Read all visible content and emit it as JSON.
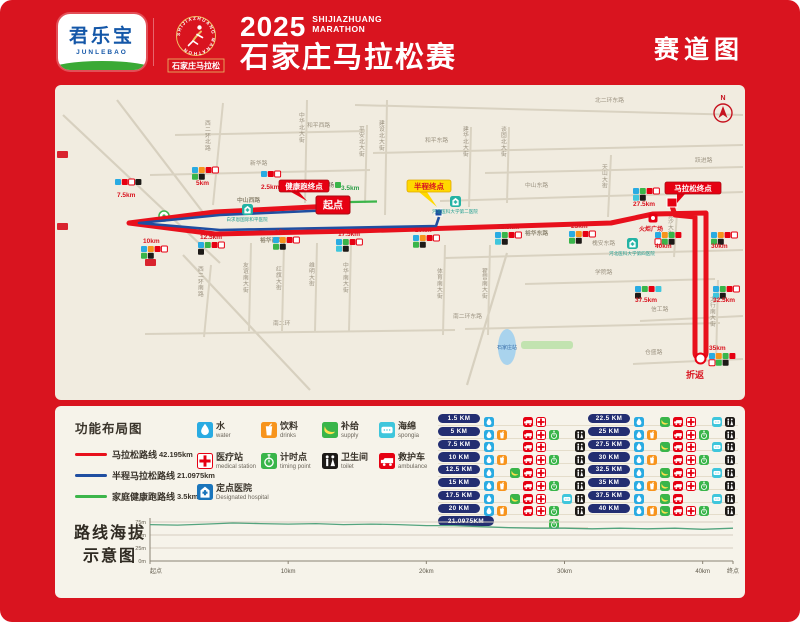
{
  "page": {
    "bg": "#d9141f",
    "map_bg": "#f1ece0",
    "panel_bg": "#f6f3ea"
  },
  "header": {
    "sponsor": {
      "cn": "君乐宝",
      "en": "JUNLEBAO"
    },
    "emblem": {
      "arc": "SHIJIAZHUANG MARATHON",
      "cn": "石家庄马拉松"
    },
    "title": {
      "year": "2025",
      "en_line1": "SHIJIAZHUANG",
      "en_line2": "MARATHON",
      "cn": "石家庄马拉松赛"
    },
    "page_label": "赛道图"
  },
  "map": {
    "north": "N",
    "diagonals": [
      [
        8,
        30,
        165,
        178
      ],
      [
        62,
        15,
        150,
        130
      ],
      [
        128,
        170,
        255,
        305
      ],
      [
        452,
        168,
        412,
        300
      ]
    ],
    "streets": [
      [
        300,
        20,
        688,
        30,
        "北二环东路",
        540,
        17,
        0
      ],
      [
        120,
        50,
        310,
        46,
        "和平西路",
        252,
        42,
        0
      ],
      [
        318,
        68,
        688,
        60,
        "和平东路",
        370,
        57,
        0
      ],
      [
        95,
        90,
        315,
        85,
        "新华路",
        195,
        80,
        0
      ],
      [
        430,
        88,
        688,
        82,
        "跃进路",
        640,
        77,
        0
      ],
      [
        385,
        116,
        688,
        107,
        "中山东路",
        470,
        102,
        0
      ],
      [
        390,
        173,
        688,
        165,
        "槐安东路",
        537,
        160,
        0
      ],
      [
        470,
        199,
        660,
        194,
        "学院路",
        540,
        189,
        0
      ],
      [
        90,
        249,
        400,
        245,
        "南二环",
        218,
        240,
        0
      ],
      [
        410,
        244,
        665,
        238,
        "南二环东路",
        398,
        233,
        0
      ],
      [
        585,
        236,
        688,
        231,
        "信工路",
        596,
        226,
        0
      ],
      [
        578,
        279,
        688,
        274,
        "仓盛路",
        590,
        269,
        0
      ],
      [
        168,
        18,
        158,
        120,
        "西二环北路",
        150,
        40,
        1
      ],
      [
        156,
        180,
        149,
        252,
        "西二环南路",
        143,
        186,
        1
      ],
      [
        252,
        15,
        250,
        118,
        "中华北大街",
        244,
        32,
        1
      ],
      [
        312,
        40,
        310,
        118,
        "平安北大街",
        304,
        46,
        1
      ],
      [
        332,
        15,
        330,
        130,
        "建设北大街",
        324,
        40,
        1
      ],
      [
        416,
        42,
        414,
        122,
        "建华北大街",
        408,
        46,
        1
      ],
      [
        454,
        42,
        452,
        118,
        "谈固北大街",
        446,
        46,
        1
      ],
      [
        196,
        158,
        194,
        246,
        "友谊南大街",
        188,
        182,
        1
      ],
      [
        229,
        158,
        227,
        246,
        "红旗大街",
        221,
        186,
        1
      ],
      [
        262,
        158,
        260,
        246,
        "维明大街",
        254,
        182,
        1
      ],
      [
        296,
        158,
        294,
        246,
        "中华南大街",
        288,
        182,
        1
      ],
      [
        390,
        160,
        388,
        250,
        "体育南大街",
        382,
        188,
        1
      ],
      [
        435,
        160,
        433,
        250,
        "翟营南大街",
        427,
        188,
        1
      ],
      [
        556,
        70,
        553,
        132,
        "天山大街",
        547,
        84,
        1
      ],
      [
        622,
        128,
        619,
        172,
        "金沙大街",
        613,
        132,
        1
      ],
      [
        663,
        195,
        661,
        278,
        "太行南大街",
        655,
        216,
        1
      ]
    ],
    "route_labels": [
      {
        "t": "中山西路",
        "x": 182,
        "y": 117
      },
      {
        "t": "裕华西路",
        "x": 205,
        "y": 157
      },
      {
        "t": "裕华东路",
        "x": 470,
        "y": 150
      }
    ],
    "routes": {
      "marathon": {
        "color": "#e8101c",
        "width": 5,
        "d": "M277 121 L160 127 L74 138 L160 149 L300 146 L430 142 L556 138 L598 129 L651 128 L651 268 A5.5 5.5 0 0 1 640 268 L640 132 L620 130 L617 121"
      },
      "half": {
        "color": "#1f4ea1",
        "width": 2.6,
        "d": "M279 125 L165 130 L84 138 L165 145 L381 141 L384 132"
      },
      "family": {
        "color": "#3cb54a",
        "width": 2.2,
        "d": "M272 117.5 L322 116.5"
      }
    },
    "start": {
      "label": "起点",
      "x": 261,
      "y": 111,
      "w": 34,
      "h": 18
    },
    "half_end": {
      "x": 380,
      "y": 124
    },
    "finish_flag": {
      "x": 612,
      "y": 113
    },
    "uturn": {
      "x": 645.5,
      "y": 273.5,
      "label": "折返",
      "lx": 631,
      "ly": 293
    },
    "callouts": [
      {
        "t": "健康跑终点",
        "x": 224,
        "y": 95,
        "w": 50,
        "h": 12,
        "style": "red",
        "tx": 252,
        "ty": 116
      },
      {
        "t": "半程终点",
        "x": 352,
        "y": 95,
        "w": 44,
        "h": 12,
        "style": "yellow",
        "tx": 382,
        "ty": 122
      },
      {
        "t": "马拉松终点",
        "x": 610,
        "y": 97,
        "w": 56,
        "h": 12,
        "style": "red",
        "tx": 622,
        "ty": 118
      }
    ],
    "markers": [
      {
        "t": "2.5km",
        "lx": 206,
        "ly": 104,
        "cx": 206,
        "cy": 86,
        "icons": [
          "w",
          "a",
          "m"
        ]
      },
      {
        "t": "5km",
        "lx": 141,
        "ly": 100,
        "cx": 137,
        "cy": 82,
        "icons": [
          "w",
          "d",
          "a",
          "m",
          "t",
          "c"
        ]
      },
      {
        "t": "7.5km",
        "lx": 62,
        "ly": 112,
        "cx": 60,
        "cy": 94,
        "icons": [
          "w",
          "a",
          "m",
          "c"
        ]
      },
      {
        "t": "10km",
        "lx": 88,
        "ly": 158,
        "cx": 86,
        "cy": 161,
        "icons": [
          "w",
          "d",
          "a",
          "m",
          "t",
          "c"
        ]
      },
      {
        "t": "12.5km",
        "lx": 145,
        "ly": 154,
        "cx": 143,
        "cy": 157,
        "icons": [
          "w",
          "s",
          "a",
          "m",
          "c"
        ]
      },
      {
        "t": "15km",
        "lx": 220,
        "ly": 149,
        "cx": 218,
        "cy": 152,
        "icons": [
          "w",
          "d",
          "a",
          "m",
          "t",
          "c"
        ]
      },
      {
        "t": "17.5km",
        "lx": 283,
        "ly": 151,
        "cx": 281,
        "cy": 154,
        "icons": [
          "w",
          "s",
          "a",
          "m",
          "g",
          "c"
        ]
      },
      {
        "t": "20km",
        "lx": 360,
        "ly": 147,
        "cx": 358,
        "cy": 150,
        "icons": [
          "w",
          "d",
          "a",
          "m",
          "t",
          "c"
        ]
      },
      {
        "t": "22.5km",
        "lx": 442,
        "ly": 144,
        "cx": 440,
        "cy": 147,
        "icons": [
          "w",
          "s",
          "a",
          "m",
          "g",
          "c"
        ]
      },
      {
        "t": "25km",
        "lx": 516,
        "ly": 143,
        "cx": 514,
        "cy": 146,
        "icons": [
          "w",
          "d",
          "a",
          "m",
          "t",
          "c"
        ]
      },
      {
        "t": "27.5km",
        "lx": 578,
        "ly": 121,
        "cx": 578,
        "cy": 103,
        "icons": [
          "w",
          "s",
          "a",
          "m",
          "g",
          "c"
        ]
      },
      {
        "t": "30km",
        "lx": 656,
        "ly": 163,
        "cx": 656,
        "cy": 147,
        "icons": [
          "w",
          "d",
          "a",
          "m",
          "t",
          "c"
        ]
      },
      {
        "t": "32.5km",
        "lx": 658,
        "ly": 217,
        "cx": 658,
        "cy": 201,
        "icons": [
          "w",
          "s",
          "a",
          "m",
          "g",
          "c"
        ]
      },
      {
        "t": "35km",
        "lx": 654,
        "ly": 265,
        "cx": 654,
        "cy": 268,
        "icons": [
          "w",
          "d",
          "s",
          "a",
          "m",
          "t",
          "c"
        ]
      },
      {
        "t": "37.5km",
        "lx": 580,
        "ly": 217,
        "cx": 580,
        "cy": 201,
        "icons": [
          "w",
          "s",
          "a",
          "g",
          "c"
        ]
      },
      {
        "t": "40km",
        "lx": 600,
        "ly": 163,
        "cx": 600,
        "cy": 147,
        "icons": [
          "w",
          "d",
          "s",
          "a",
          "m",
          "t",
          "c"
        ]
      },
      {
        "t": "3.5km",
        "lx": 286,
        "ly": 105,
        "cx": 280,
        "cy": 97,
        "icons": [
          "t"
        ],
        "green": true
      }
    ],
    "landmarks": {
      "plazas": [
        {
          "t": "新百广场",
          "x": 252,
          "y": 100,
          "style": "dot"
        },
        {
          "t": "火炬广场",
          "x": 598,
          "y": 133,
          "style": "torch"
        }
      ],
      "hospitals": [
        {
          "t": "白求恩国际和平医院",
          "x": 192,
          "y": 124
        },
        {
          "t": "河北医科大学第二医院",
          "x": 400,
          "y": 116
        },
        {
          "t": "河北医科大学第四医院",
          "x": 577,
          "y": 158
        }
      ],
      "station": {
        "t": "石家庄站",
        "x": 452,
        "y": 262
      },
      "green_ring": {
        "x": 109,
        "y": 131
      },
      "signs": [
        [
          2,
          66
        ],
        [
          2,
          138
        ],
        [
          90,
          174
        ]
      ]
    }
  },
  "legend": {
    "title": "功能布局图",
    "routes": [
      {
        "color": "#e8101c",
        "label": "马拉松路线",
        "dist": "42.195km"
      },
      {
        "color": "#1f4ea1",
        "label": "半程马拉松路线",
        "dist": "21.0975km"
      },
      {
        "color": "#3cb54a",
        "label": "家庭健康跑路线",
        "dist": "3.5km"
      }
    ],
    "facilities": [
      {
        "type": "w",
        "cn": "水",
        "en": "water"
      },
      {
        "type": "d",
        "cn": "饮料",
        "en": "drinks"
      },
      {
        "type": "s",
        "cn": "补给",
        "en": "supply"
      },
      {
        "type": "g",
        "cn": "海绵",
        "en": "spongia"
      },
      {
        "type": "m",
        "cn": "医疗站",
        "en": "medical station"
      },
      {
        "type": "t",
        "cn": "计时点",
        "en": "timing point"
      },
      {
        "type": "c",
        "cn": "卫生间",
        "en": "toilet"
      },
      {
        "type": "a",
        "cn": "救护车",
        "en": "ambulance"
      },
      {
        "type": "h",
        "cn": "定点医院",
        "en": "Designated hospital"
      }
    ]
  },
  "km_grid": {
    "left": [
      {
        "label": "1.5 KM",
        "icons": [
          "w",
          "",
          "",
          "a",
          "m",
          "",
          "",
          ""
        ]
      },
      {
        "label": "5 KM",
        "icons": [
          "w",
          "d",
          "",
          "a",
          "m",
          "t",
          "",
          "c"
        ]
      },
      {
        "label": "7.5 KM",
        "icons": [
          "w",
          "",
          "",
          "a",
          "m",
          "",
          "",
          "c"
        ]
      },
      {
        "label": "10 KM",
        "icons": [
          "w",
          "d",
          "",
          "a",
          "m",
          "t",
          "",
          "c"
        ]
      },
      {
        "label": "12.5 KM",
        "icons": [
          "w",
          "",
          "s",
          "a",
          "m",
          "",
          "",
          "c"
        ]
      },
      {
        "label": "15 KM",
        "icons": [
          "w",
          "d",
          "",
          "a",
          "m",
          "t",
          "",
          "c"
        ]
      },
      {
        "label": "17.5 KM",
        "icons": [
          "w",
          "",
          "s",
          "a",
          "m",
          "",
          "g",
          "c"
        ]
      },
      {
        "label": "20 KM",
        "icons": [
          "w",
          "d",
          "",
          "a",
          "m",
          "t",
          "",
          "c"
        ]
      },
      {
        "label": "21.0975KM",
        "icons": [
          "",
          "",
          "",
          "",
          "",
          "t",
          "",
          ""
        ],
        "wide": true
      }
    ],
    "right": [
      {
        "label": "22.5 KM",
        "icons": [
          "w",
          "",
          "s",
          "a",
          "m",
          "",
          "g",
          "c"
        ]
      },
      {
        "label": "25 KM",
        "icons": [
          "w",
          "d",
          "",
          "a",
          "m",
          "t",
          "",
          "c"
        ]
      },
      {
        "label": "27.5 KM",
        "icons": [
          "w",
          "",
          "s",
          "a",
          "m",
          "",
          "g",
          "c"
        ]
      },
      {
        "label": "30 KM",
        "icons": [
          "w",
          "d",
          "",
          "a",
          "m",
          "t",
          "",
          "c"
        ]
      },
      {
        "label": "32.5 KM",
        "icons": [
          "w",
          "",
          "s",
          "a",
          "m",
          "",
          "g",
          "c"
        ]
      },
      {
        "label": "35 KM",
        "icons": [
          "w",
          "d",
          "s",
          "a",
          "m",
          "t",
          "",
          "c"
        ]
      },
      {
        "label": "37.5 KM",
        "icons": [
          "w",
          "",
          "s",
          "a",
          "",
          "",
          "g",
          "c"
        ]
      },
      {
        "label": "40 KM",
        "icons": [
          "w",
          "d",
          "s",
          "a",
          "m",
          "t",
          "",
          "c"
        ]
      }
    ]
  },
  "elevation": {
    "title_line1": "路线海拔",
    "title_line2": "示意图"
  },
  "chart_data": {
    "type": "line",
    "title": "路线海拔示意图",
    "x_km": [
      0,
      2,
      4,
      6,
      8,
      10,
      12,
      14,
      16,
      18,
      20,
      22,
      24,
      26,
      28,
      30,
      32,
      34,
      36,
      38,
      40,
      42.195
    ],
    "elevation_m": [
      70,
      69,
      71,
      73,
      72,
      71,
      72,
      70,
      71,
      70,
      68,
      68,
      66,
      64,
      63,
      63,
      62,
      63,
      62,
      63,
      61,
      63
    ],
    "xticks": [
      {
        "km": 0,
        "label": "起点"
      },
      {
        "km": 10,
        "label": "10km"
      },
      {
        "km": 20,
        "label": "20km"
      },
      {
        "km": 30,
        "label": "30km"
      },
      {
        "km": 40,
        "label": "40km"
      },
      {
        "km": 42.195,
        "label": "终点"
      }
    ],
    "yticks": [
      {
        "m": 0,
        "label": "0m"
      },
      {
        "m": 25,
        "label": "25m"
      },
      {
        "m": 50,
        "label": "50m"
      },
      {
        "m": 75,
        "label": "75m"
      }
    ],
    "ylim": [
      0,
      85
    ],
    "grid": true,
    "line_color": "#53a47e"
  }
}
